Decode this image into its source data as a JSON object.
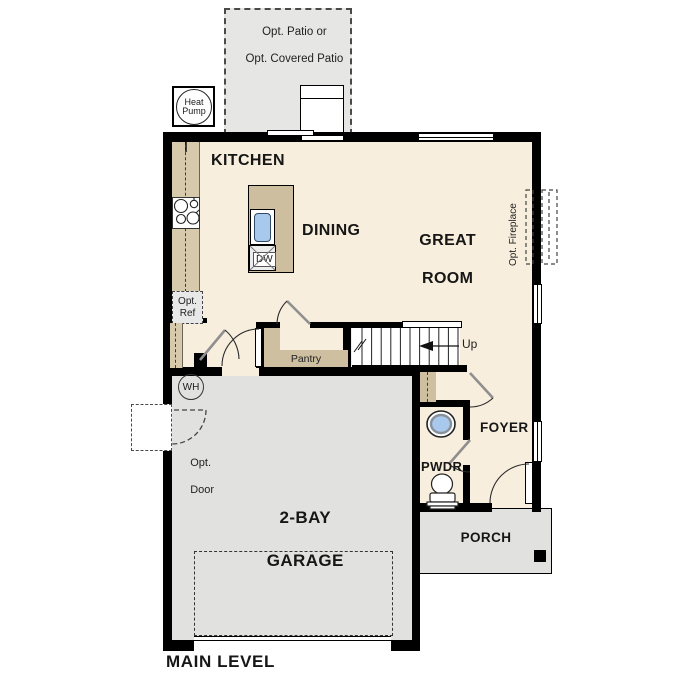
{
  "plan": {
    "level_label": "MAIN LEVEL",
    "rooms": {
      "kitchen": "KITCHEN",
      "dining": "DINING",
      "great_room": [
        "GREAT",
        "ROOM"
      ],
      "garage": [
        "2-BAY",
        "GARAGE"
      ],
      "foyer": "FOYER",
      "pwdr": "PWDR",
      "porch": "PORCH",
      "pantry": "Pantry"
    },
    "annotations": {
      "patio": [
        "Opt. Patio or",
        "Opt. Covered Patio"
      ],
      "heat_pump": [
        "Heat",
        "Pump"
      ],
      "opt_fireplace": "Opt. Fireplace",
      "opt_ref": [
        "Opt.",
        "Ref"
      ],
      "opt_door": [
        "Opt.",
        "Door"
      ],
      "dw": "DW",
      "up": "Up",
      "wh": "WH"
    },
    "colors": {
      "wall": "#000000",
      "floor": "#f7eedd",
      "counter_tan": "#d7c9ab",
      "island_tan": "#ccbe9e",
      "shelf_tan": "#cdbf9f",
      "garage_gray": "#e1e1e0",
      "patio_gray": "#e6e6e4",
      "optional_gray": "#e8e8e8",
      "sink_blue": "#a9c9ec"
    }
  }
}
